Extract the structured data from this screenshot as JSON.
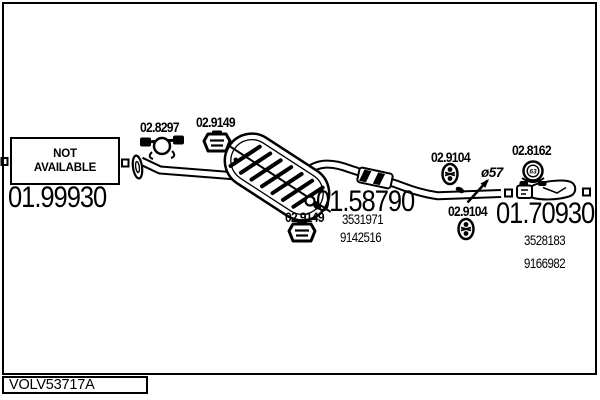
{
  "drawing": {
    "catalog_code": "VOLV53717A",
    "availability_note": {
      "line1": "NOT",
      "line2": "AVAILABLE"
    },
    "front_section": {
      "part_number": "01.99930"
    },
    "middle_silencer": {
      "part_number": "01.58790",
      "oe_numbers": [
        "3531971",
        "9142516"
      ]
    },
    "rear_silencer": {
      "part_number": "01.70930",
      "oe_numbers": [
        "3528183",
        "9166982"
      ]
    },
    "fittings": [
      {
        "code": "02.8297",
        "type": "pipe-clamp"
      },
      {
        "code": "02.9149",
        "type": "rubber-hanger-top"
      },
      {
        "code": "02.9149",
        "type": "rubber-hanger-bottom"
      },
      {
        "code": "02.9104",
        "type": "rubber-mount-upper"
      },
      {
        "code": "02.9104",
        "type": "rubber-mount-lower"
      },
      {
        "code": "02.8162",
        "type": "band-clamp",
        "size_label": "63"
      }
    ],
    "annotations": {
      "pipe_diameter": "ø57"
    },
    "colors": {
      "line": "#000000",
      "background": "#ffffff"
    }
  }
}
